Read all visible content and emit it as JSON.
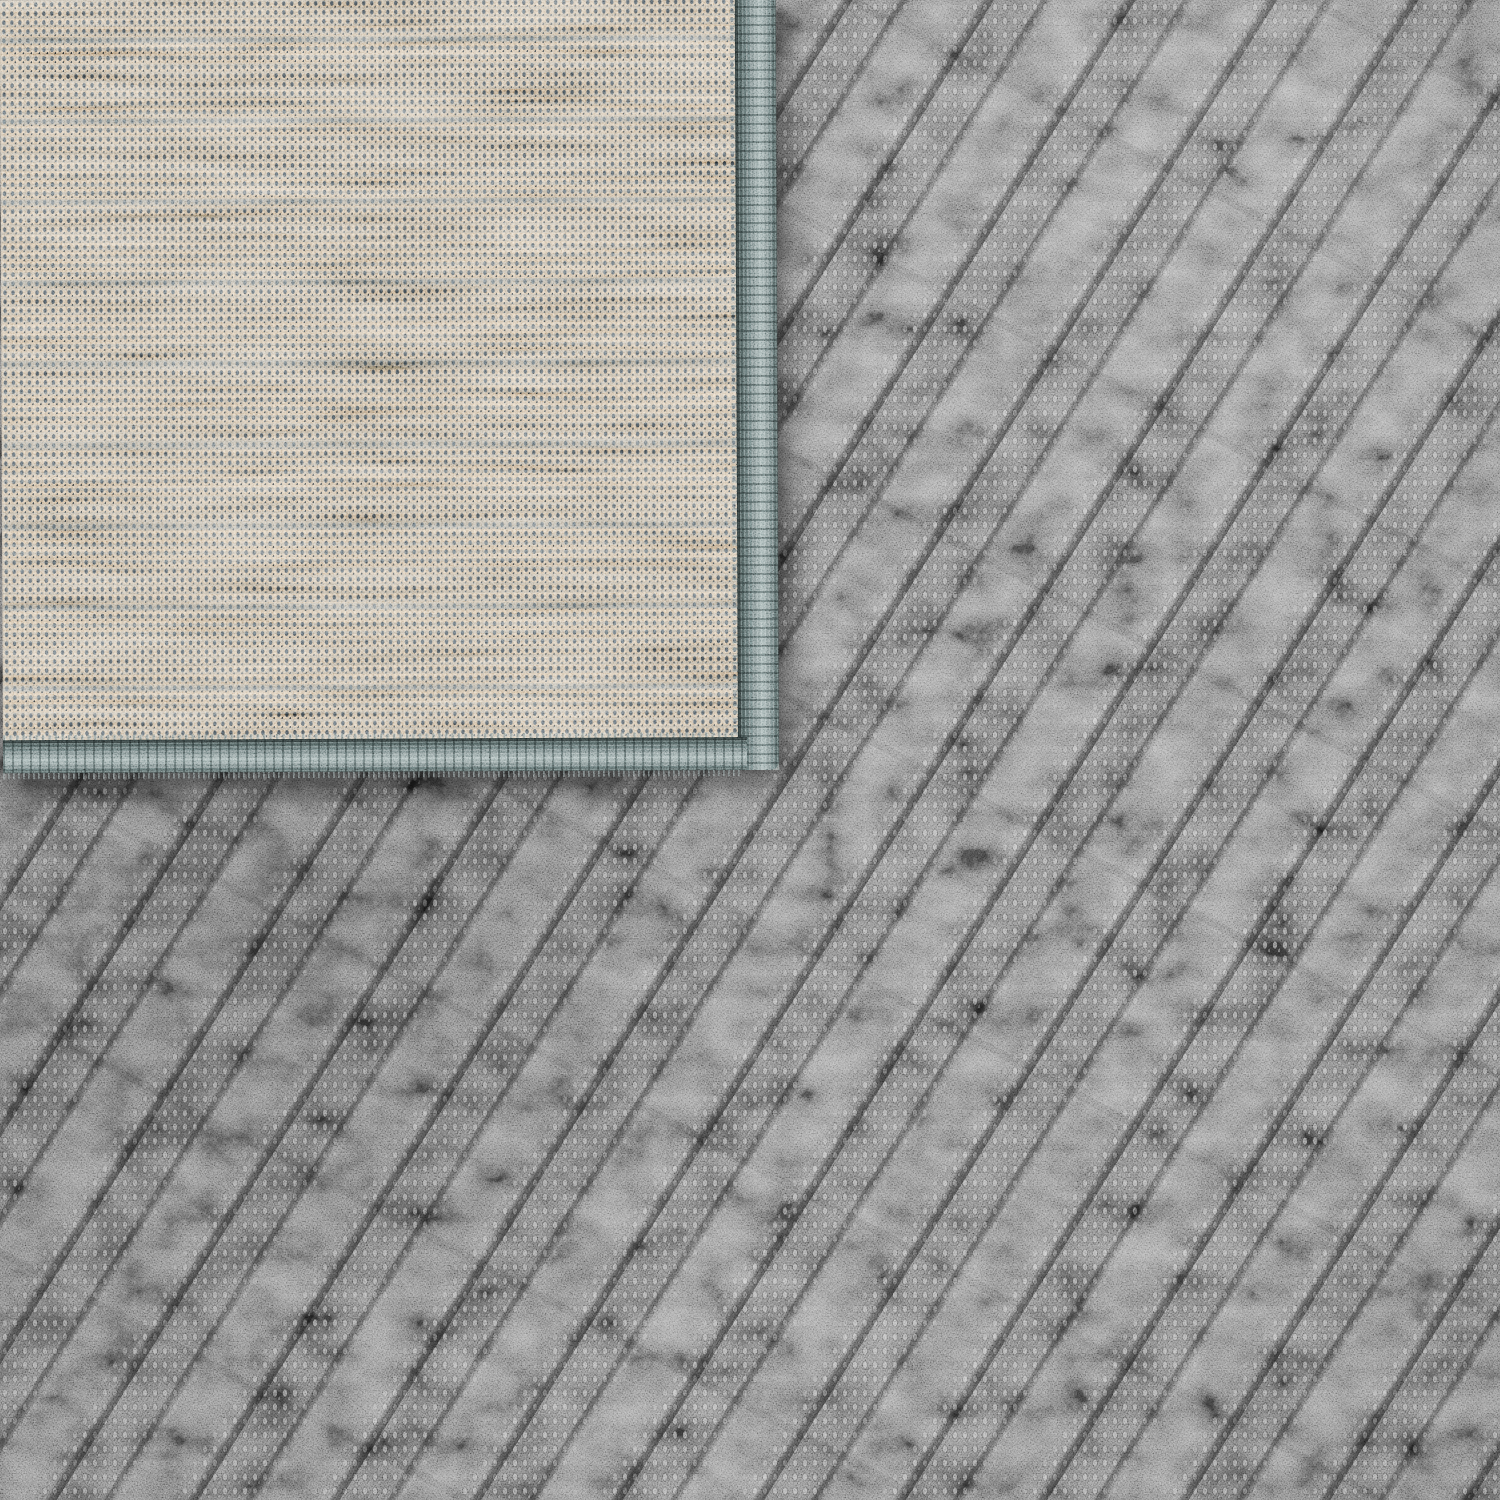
{
  "scene": {
    "type": "photograph",
    "subject": "Close-up of an area rug with its top-left corner folded back",
    "rug_surface": "Anthracite-gray carpet with a carved high-low pile forming diagonal geometric ridges; mix of fluffy raised pile and flat knitted stitch rows",
    "folded_corner": "Flat-woven beige backing speckled with slate-gray warp dots and horizontal gray weft streaks",
    "edge_binding": "Slate teal-gray serged overlock binding along the right and bottom edges of the folded corner, with loose stitch fringe",
    "lighting": "Soft even light, brighter toward upper right, shadow cast by the folded corner onto the pile below"
  },
  "palette": {
    "rug-base": "#686868",
    "rug-dark": "#2a2a2a",
    "rug-light": "#a8a8a8",
    "backing-base": "#c8b59b",
    "backing-light": "#dccab0",
    "backing-dot": "#4b555c",
    "backing-dot-dark": "#2e373d",
    "backing-streak": "#8c989c",
    "binding-base": "#6e7e7e",
    "binding-light": "#a3b3b2",
    "binding-dark": "#3f4d4c",
    "shadow": "#000000"
  },
  "layout": {
    "image_size": 1500,
    "corner_width": 776,
    "corner_height": 773,
    "binding_right_width": 38,
    "binding_bottom_height": 30,
    "fringe_height": 10,
    "corner_rotation_deg": -0.25
  }
}
